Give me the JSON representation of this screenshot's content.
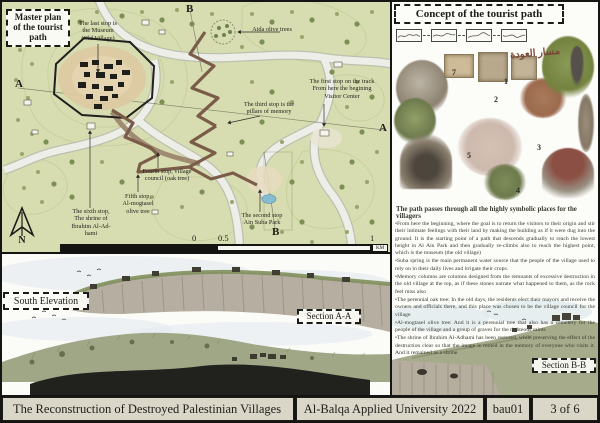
{
  "colors": {
    "map_green": "#d7ddb0",
    "tourist_path_brown": "#7a5c49",
    "pond_blue": "#86bcd1",
    "footer_beige": "#dad7c8",
    "board_frame": "#151513"
  },
  "master_plan": {
    "title": "Master plan\nof the tourist\npath",
    "letters": {
      "a": "A",
      "b": "B"
    },
    "stops": [
      "The last stop is\nthe Museum\n(Old Village)",
      "Aida olive trees",
      "The first stop on the track\nFrom here the begining\nVisitor Center",
      "The third stop is the\npillars of memory",
      "Fourth stop, village\ncouncil (oak tree)",
      "Fifth stop,\nAl-mogtasel\nolive tree",
      "The sixth stop,\nThe shrine of\nIbrahim Al-Ad-\nhami",
      "The second stop\nAin Suba Park"
    ],
    "scale_bar": {
      "zero": "0",
      "half": "0.5",
      "one": "1",
      "unit": "KM"
    },
    "north_label": "N"
  },
  "concept": {
    "title": "Concept of the tourist path",
    "arabic_note": "مسار العودة",
    "figure_numbers": [
      "7",
      "1",
      "2",
      "5",
      "3",
      "4"
    ],
    "heading": "The path passes through all the highly symbolic places for the villagers",
    "bullets": [
      "From here the beginning, where the goal is to return the visitors to their origin and stir their intimate feelings with their land by making the building as if it were dug into the ground. It is the starting point of a path that descends gradually to reach the lowest height in Al Ain Park and then gradually re-climbs also to reach the highest point, which is the museum (the old village)",
      "Suba spring is the main permanent water source that the people of the village used to rely on in their daily lives and irrigate their crops.",
      "Memory columns are columns designed from the remnants of excessive destruction in the old village at the top, as if these stones narrate what happened to them, as the rock feel miss also",
      "The perennial oak tree: In the old days, the residents elect their mayors and receive the owners and officials there, and this place was chosen to be the village council for the village",
      "Al-mogtasel olive tree: And it is a perennial tree that also has a cemetery for the people of the village and a group of graves for the righteous saints",
      "The shrine of Ibrahim Al-Adhami has been restored, while preserving the effect of the destruction clear so that the image is rooted in the memory of everyone who visits it. And it remained as a shrine"
    ]
  },
  "drawings": {
    "south_elevation": "South Elevation",
    "section_aa": "Section A-A",
    "section_bb": "Section B-B"
  },
  "footer": {
    "project_title": "The Reconstruction of Destroyed Palestinian Villages",
    "university": "Al-Balqa Applied University 2022",
    "sheet_code": "bau01",
    "page": "3 of 6"
  }
}
